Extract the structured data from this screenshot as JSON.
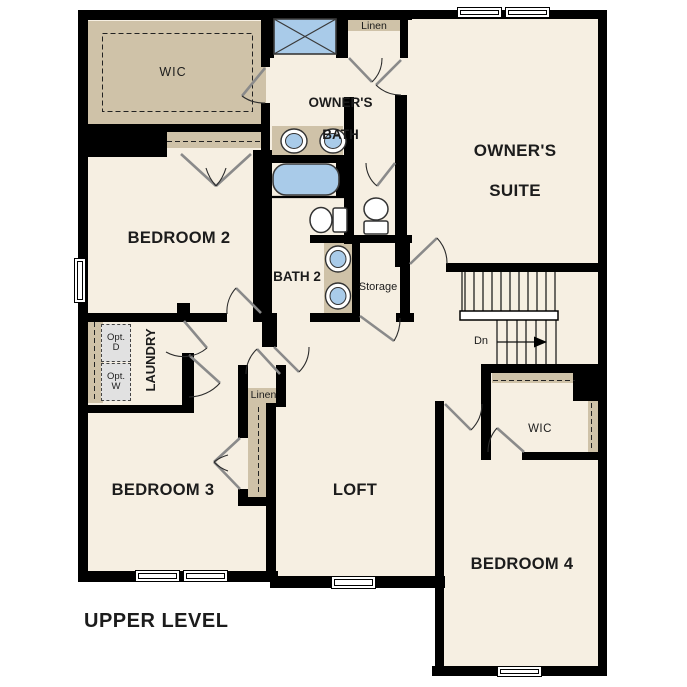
{
  "title": {
    "plan_level": "UPPER LEVEL"
  },
  "colors": {
    "floor": "#f6efe2",
    "wall": "#000000",
    "shelf": "#cfc2a8",
    "fixture": "#a9cbe9",
    "window": "#ffffff",
    "door": "#8a8a8a",
    "text": "#1c1c1c",
    "appliance": "#e1e1e1"
  },
  "rooms": {
    "wic_main": {
      "label": "WIC"
    },
    "owners_bath": {
      "line1": "OWNER'S",
      "line2": "BATH"
    },
    "owners_suite": {
      "line1": "OWNER'S",
      "line2": "SUITE"
    },
    "bedroom2": {
      "label": "BEDROOM 2"
    },
    "bath2": {
      "label": "BATH 2"
    },
    "storage": {
      "label": "Storage"
    },
    "laundry": {
      "label": "LAUNDRY"
    },
    "bedroom3": {
      "label": "BEDROOM 3"
    },
    "loft": {
      "label": "LOFT"
    },
    "bedroom4": {
      "label": "BEDROOM 4"
    },
    "wic_bedroom4": {
      "label": "WIC"
    }
  },
  "closets": {
    "linen_upper": {
      "label": "Linen"
    },
    "linen_hall": {
      "label": "Linen"
    }
  },
  "laundry_options": {
    "dryer": {
      "line1": "Opt.",
      "line2": "D"
    },
    "washer": {
      "line1": "Opt.",
      "line2": "W"
    }
  },
  "stairs": {
    "direction_label": "Dn"
  }
}
